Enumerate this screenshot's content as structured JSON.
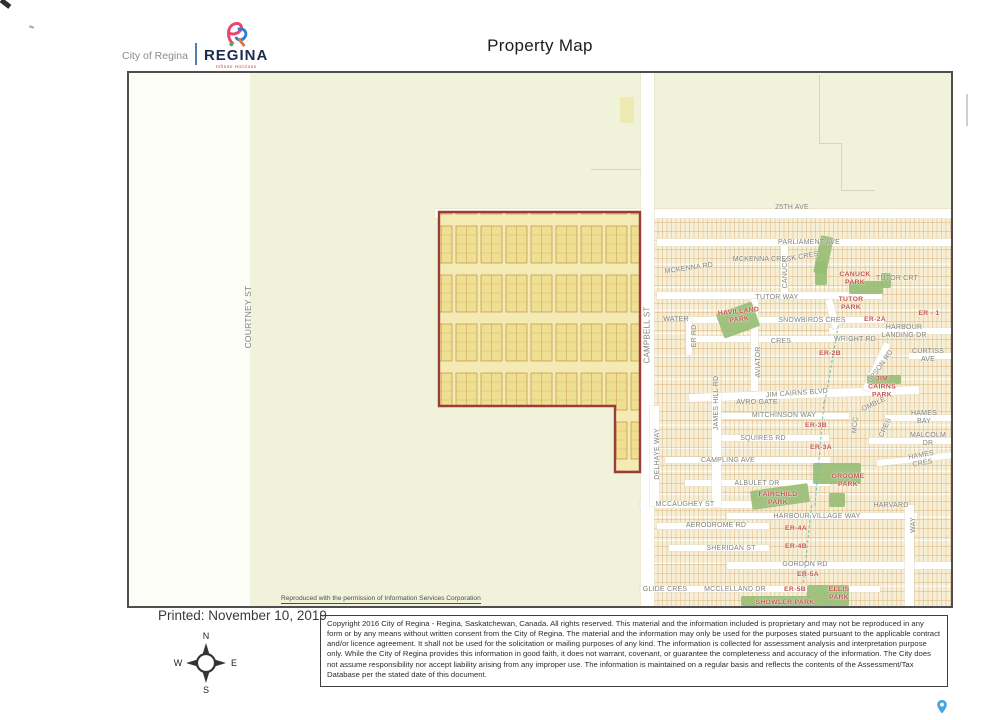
{
  "header": {
    "title": "Property Map",
    "logo": {
      "city_text": "City of Regina",
      "brand": "REGINA",
      "tagline": "Infinite Horizons"
    }
  },
  "footer": {
    "printed_line": "Printed: November 10, 2019",
    "compass": {
      "n": "N",
      "s": "S",
      "e": "E",
      "w": "W"
    },
    "copyright_text": "Copyright 2016 City of Regina - Regina, Saskatchewan, Canada. All rights reserved. This material and the information included is proprietary and may not be reproduced in any form or by any means without written consent from the City of Regina. The material and the information may only be used for the purposes stated pursuant to the applicable contract and/or licence agreement. It shall not be used for the solicitation or mailing purposes of any kind. The information is collected for assessment analysis and interpretation purpose only. While the City of Regina provides this information in good faith, it does not warrant, covenant, or guarantee the completeness and accuracy of the information. The City does not assume responsibility nor accept liability arising from any improper use. The information is maintained on a regular basis and reflects the contents of the Assessment/Tax Database per the stated date of this document."
  },
  "map": {
    "source_note": "Reproduced with the permission of Information Services Corporation",
    "colors": {
      "rural_bg": "#f0f2da",
      "urban_bg": "#f6efd6",
      "property_fill": "#efe095",
      "property_stroke": "#9c3c38",
      "park_green": "#97bd74",
      "road_white": "#ffffff",
      "label_gray": "#82827a",
      "label_red": "#c4554e"
    },
    "property": {
      "points": "310,139 511,139 511,399 486,399 486,333 310,333",
      "fill_pattern_block": "#efdf92",
      "stroke": "#9c3c38"
    },
    "labels": [
      {
        "text": "25TH AVE",
        "x": 663,
        "y": 135
      },
      {
        "text": "PARLIAMENT AVE",
        "x": 680,
        "y": 170
      },
      {
        "text": "MCKENNA CRES",
        "x": 633,
        "y": 187
      },
      {
        "text": "K CRES",
        "x": 676,
        "y": 184,
        "rot": -10
      },
      {
        "text": "MCKENNA RD",
        "x": 560,
        "y": 196,
        "rot": -8
      },
      {
        "text": "CANUCK",
        "x": 657,
        "y": 200,
        "rot": -90
      },
      {
        "text": "TUTOR CRT",
        "x": 768,
        "y": 206
      },
      {
        "text": "TUTOR WAY",
        "x": 648,
        "y": 225
      },
      {
        "text": "WATER",
        "x": 547,
        "y": 247
      },
      {
        "text": "ER RD",
        "x": 566,
        "y": 263,
        "rot": -90
      },
      {
        "text": "SNOWBIRDS CRES",
        "x": 683,
        "y": 248
      },
      {
        "text": "HARBOUR LANDING DR",
        "x": 775,
        "y": 259
      },
      {
        "text": "CRES",
        "x": 652,
        "y": 269
      },
      {
        "text": "WRIGHT RD",
        "x": 726,
        "y": 267
      },
      {
        "text": "AVIATOR",
        "x": 630,
        "y": 289,
        "rot": -90
      },
      {
        "text": "UPSON RD",
        "x": 752,
        "y": 294,
        "rot": -55
      },
      {
        "text": "CURTISS AVE",
        "x": 799,
        "y": 283
      },
      {
        "text": "JIM CAIRNS BLVD",
        "x": 668,
        "y": 321,
        "rot": -4
      },
      {
        "text": "AVRO GATE",
        "x": 628,
        "y": 330
      },
      {
        "text": "OMBLE",
        "x": 745,
        "y": 332,
        "rot": -25
      },
      {
        "text": "MITCHINSON WAY",
        "x": 655,
        "y": 343
      },
      {
        "text": "MCC",
        "x": 727,
        "y": 352,
        "rot": -85
      },
      {
        "text": "CRES",
        "x": 757,
        "y": 355,
        "rot": -65
      },
      {
        "text": "HAMES BAY",
        "x": 795,
        "y": 345
      },
      {
        "text": "JAMES HILL RD",
        "x": 588,
        "y": 330,
        "rot": -90
      },
      {
        "text": "SQUIRES RD",
        "x": 634,
        "y": 366
      },
      {
        "text": "MALCOLM DR",
        "x": 799,
        "y": 367
      },
      {
        "text": "DELHAYE WAY",
        "x": 529,
        "y": 381,
        "rot": -90
      },
      {
        "text": "CAMPLING AVE",
        "x": 599,
        "y": 388
      },
      {
        "text": "HAMES CRES",
        "x": 793,
        "y": 387,
        "rot": -10
      },
      {
        "text": "ALBULET DR",
        "x": 628,
        "y": 411
      },
      {
        "text": "MCCAUGHEY ST",
        "x": 556,
        "y": 432
      },
      {
        "text": "HARVARD",
        "x": 762,
        "y": 433
      },
      {
        "text": "WAY",
        "x": 785,
        "y": 452,
        "rot": -90
      },
      {
        "text": "HARBOUR VILLAGE WAY",
        "x": 688,
        "y": 444
      },
      {
        "text": "AERODROME RD",
        "x": 587,
        "y": 453
      },
      {
        "text": "SHERIDAN ST",
        "x": 602,
        "y": 476
      },
      {
        "text": "GORDON RD",
        "x": 676,
        "y": 492
      },
      {
        "text": "GLIDE CRES",
        "x": 536,
        "y": 517
      },
      {
        "text": "MCCLELLAND DR",
        "x": 606,
        "y": 517
      },
      {
        "text": "COURTNEY ST",
        "x": 120,
        "y": 244,
        "rot": -90,
        "s": 8.5
      },
      {
        "text": "CAMPBELL ST",
        "x": 518,
        "y": 262,
        "rot": -90,
        "s": 8
      },
      {
        "text": "CANUCK\nPARK",
        "x": 726,
        "y": 206,
        "c": "r"
      },
      {
        "text": "TUTOR\nPARK",
        "x": 722,
        "y": 231,
        "c": "r"
      },
      {
        "text": "ER - 1",
        "x": 800,
        "y": 241,
        "c": "r"
      },
      {
        "text": "HAVILLAND\nPARK",
        "x": 610,
        "y": 243,
        "c": "r",
        "rot": -6
      },
      {
        "text": "ER-2A",
        "x": 746,
        "y": 247,
        "c": "r"
      },
      {
        "text": "ER-2B",
        "x": 701,
        "y": 281,
        "c": "r"
      },
      {
        "text": "JIM\nCAIRNS\nPARK",
        "x": 753,
        "y": 314,
        "c": "r"
      },
      {
        "text": "ER-3B",
        "x": 687,
        "y": 353,
        "c": "r"
      },
      {
        "text": "ER-3A",
        "x": 692,
        "y": 375,
        "c": "r"
      },
      {
        "text": "GROOME\nPARK",
        "x": 719,
        "y": 408,
        "c": "r"
      },
      {
        "text": "FAIRCHILD\nPARK",
        "x": 649,
        "y": 426,
        "c": "r"
      },
      {
        "text": "ER-4A",
        "x": 667,
        "y": 456,
        "c": "r"
      },
      {
        "text": "ER-4B",
        "x": 667,
        "y": 474,
        "c": "r"
      },
      {
        "text": "ER-5A",
        "x": 679,
        "y": 502,
        "c": "r"
      },
      {
        "text": "ER-5B",
        "x": 666,
        "y": 517,
        "c": "r"
      },
      {
        "text": "ELLIS\nPARK",
        "x": 710,
        "y": 521,
        "c": "r"
      },
      {
        "text": "SHOWLER PARK",
        "x": 656,
        "y": 530,
        "c": "r"
      }
    ],
    "roads": [
      {
        "x": 306,
        "y": 136,
        "w": 520,
        "h": 9
      },
      {
        "x": 528,
        "y": 166,
        "w": 298,
        "h": 7
      },
      {
        "x": 528,
        "y": 219,
        "w": 225,
        "h": 7
      },
      {
        "x": 560,
        "y": 244,
        "w": 195,
        "h": 6
      },
      {
        "x": 700,
        "y": 255,
        "w": 126,
        "h": 6
      },
      {
        "x": 560,
        "y": 263,
        "w": 160,
        "h": 6
      },
      {
        "x": 780,
        "y": 280,
        "w": 46,
        "h": 6
      },
      {
        "x": 560,
        "y": 317,
        "w": 230,
        "h": 8,
        "rot": -2
      },
      {
        "x": 590,
        "y": 340,
        "w": 130,
        "h": 6
      },
      {
        "x": 756,
        "y": 342,
        "w": 70,
        "h": 6
      },
      {
        "x": 590,
        "y": 362,
        "w": 110,
        "h": 6
      },
      {
        "x": 740,
        "y": 365,
        "w": 86,
        "h": 6
      },
      {
        "x": 536,
        "y": 384,
        "w": 165,
        "h": 6
      },
      {
        "x": 748,
        "y": 383,
        "w": 78,
        "h": 6,
        "rot": -6
      },
      {
        "x": 556,
        "y": 407,
        "w": 145,
        "h": 6
      },
      {
        "x": 511,
        "y": 428,
        "w": 130,
        "h": 7
      },
      {
        "x": 598,
        "y": 440,
        "w": 190,
        "h": 6
      },
      {
        "x": 528,
        "y": 450,
        "w": 112,
        "h": 6
      },
      {
        "x": 540,
        "y": 472,
        "w": 100,
        "h": 6
      },
      {
        "x": 598,
        "y": 489,
        "w": 228,
        "h": 7
      },
      {
        "x": 511,
        "y": 513,
        "w": 240,
        "h": 6
      },
      {
        "x": 512,
        "y": 0,
        "w": 13,
        "h": 537
      },
      {
        "x": 583,
        "y": 322,
        "w": 9,
        "h": 112
      },
      {
        "x": 521,
        "y": 333,
        "w": 9,
        "h": 100
      },
      {
        "x": 776,
        "y": 432,
        "w": 9,
        "h": 105
      },
      {
        "x": 622,
        "y": 226,
        "w": 7,
        "h": 92
      },
      {
        "x": 652,
        "y": 172,
        "w": 7,
        "h": 54
      },
      {
        "x": 557,
        "y": 246,
        "w": 6,
        "h": 36
      },
      {
        "x": 744,
        "y": 268,
        "w": 7,
        "h": 52,
        "rot": 25
      },
      {
        "x": 700,
        "y": 226,
        "w": 7,
        "h": 30,
        "rot": -15
      }
    ],
    "parks": [
      {
        "x": 688,
        "y": 163,
        "w": 13,
        "h": 38,
        "rot": 12
      },
      {
        "x": 686,
        "y": 188,
        "w": 12,
        "h": 24
      },
      {
        "x": 720,
        "y": 208,
        "w": 34,
        "h": 13
      },
      {
        "x": 752,
        "y": 200,
        "w": 10,
        "h": 15
      },
      {
        "x": 590,
        "y": 234,
        "w": 38,
        "h": 26,
        "rot": -20
      },
      {
        "x": 738,
        "y": 302,
        "w": 34,
        "h": 9
      },
      {
        "x": 684,
        "y": 390,
        "w": 48,
        "h": 21
      },
      {
        "x": 622,
        "y": 414,
        "w": 58,
        "h": 19,
        "rot": -8
      },
      {
        "x": 700,
        "y": 420,
        "w": 16,
        "h": 14
      },
      {
        "x": 678,
        "y": 512,
        "w": 42,
        "h": 21
      },
      {
        "x": 612,
        "y": 523,
        "w": 70,
        "h": 10
      }
    ],
    "creek_segments": [
      {
        "x": 702,
        "y": 252,
        "h": 78,
        "rot": 10
      },
      {
        "x": 690,
        "y": 328,
        "h": 105,
        "rot": 5
      },
      {
        "x": 678,
        "y": 432,
        "h": 78,
        "rot": 6
      }
    ],
    "faint_lines": [
      {
        "x": 690,
        "y": 2,
        "w": 1,
        "h": 68
      },
      {
        "x": 690,
        "y": 70,
        "w": 23,
        "h": 1
      },
      {
        "x": 712,
        "y": 70,
        "w": 1,
        "h": 48
      },
      {
        "x": 712,
        "y": 117,
        "w": 34,
        "h": 1
      },
      {
        "x": 462,
        "y": 96,
        "w": 50,
        "h": 1
      }
    ],
    "patches": [
      {
        "x": 491,
        "y": 24,
        "w": 14,
        "h": 26
      }
    ]
  }
}
